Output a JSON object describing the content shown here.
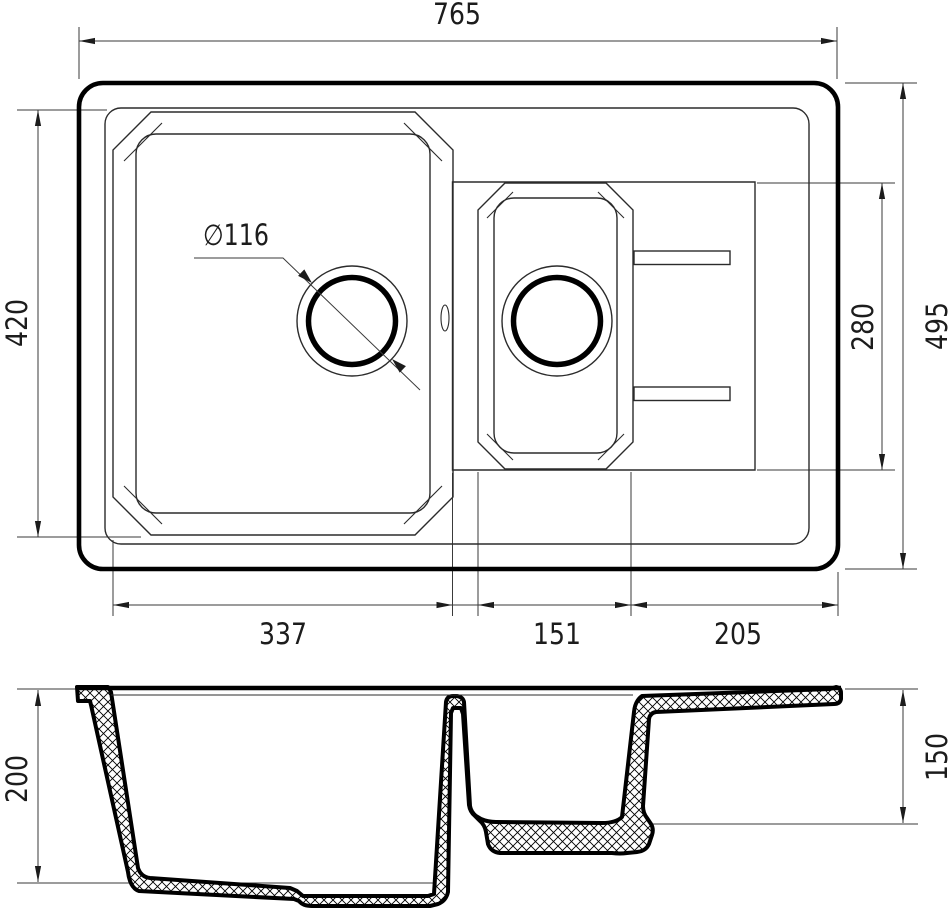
{
  "drawing_title": "Kitchen sink technical drawing, top view and section view",
  "colors": {
    "line": "#000000",
    "dim_line": "#3a3a3a",
    "background": "#ffffff"
  },
  "dims": {
    "overall_width": "765",
    "main_bowl_height": "420",
    "overall_depth": "495",
    "small_bowl_height": "280",
    "main_bowl_width": "337",
    "small_bowl_width": "151",
    "drainer_width": "205",
    "drain_diameter": "∅116",
    "main_bowl_depth": "200",
    "small_bowl_depth": "150"
  }
}
